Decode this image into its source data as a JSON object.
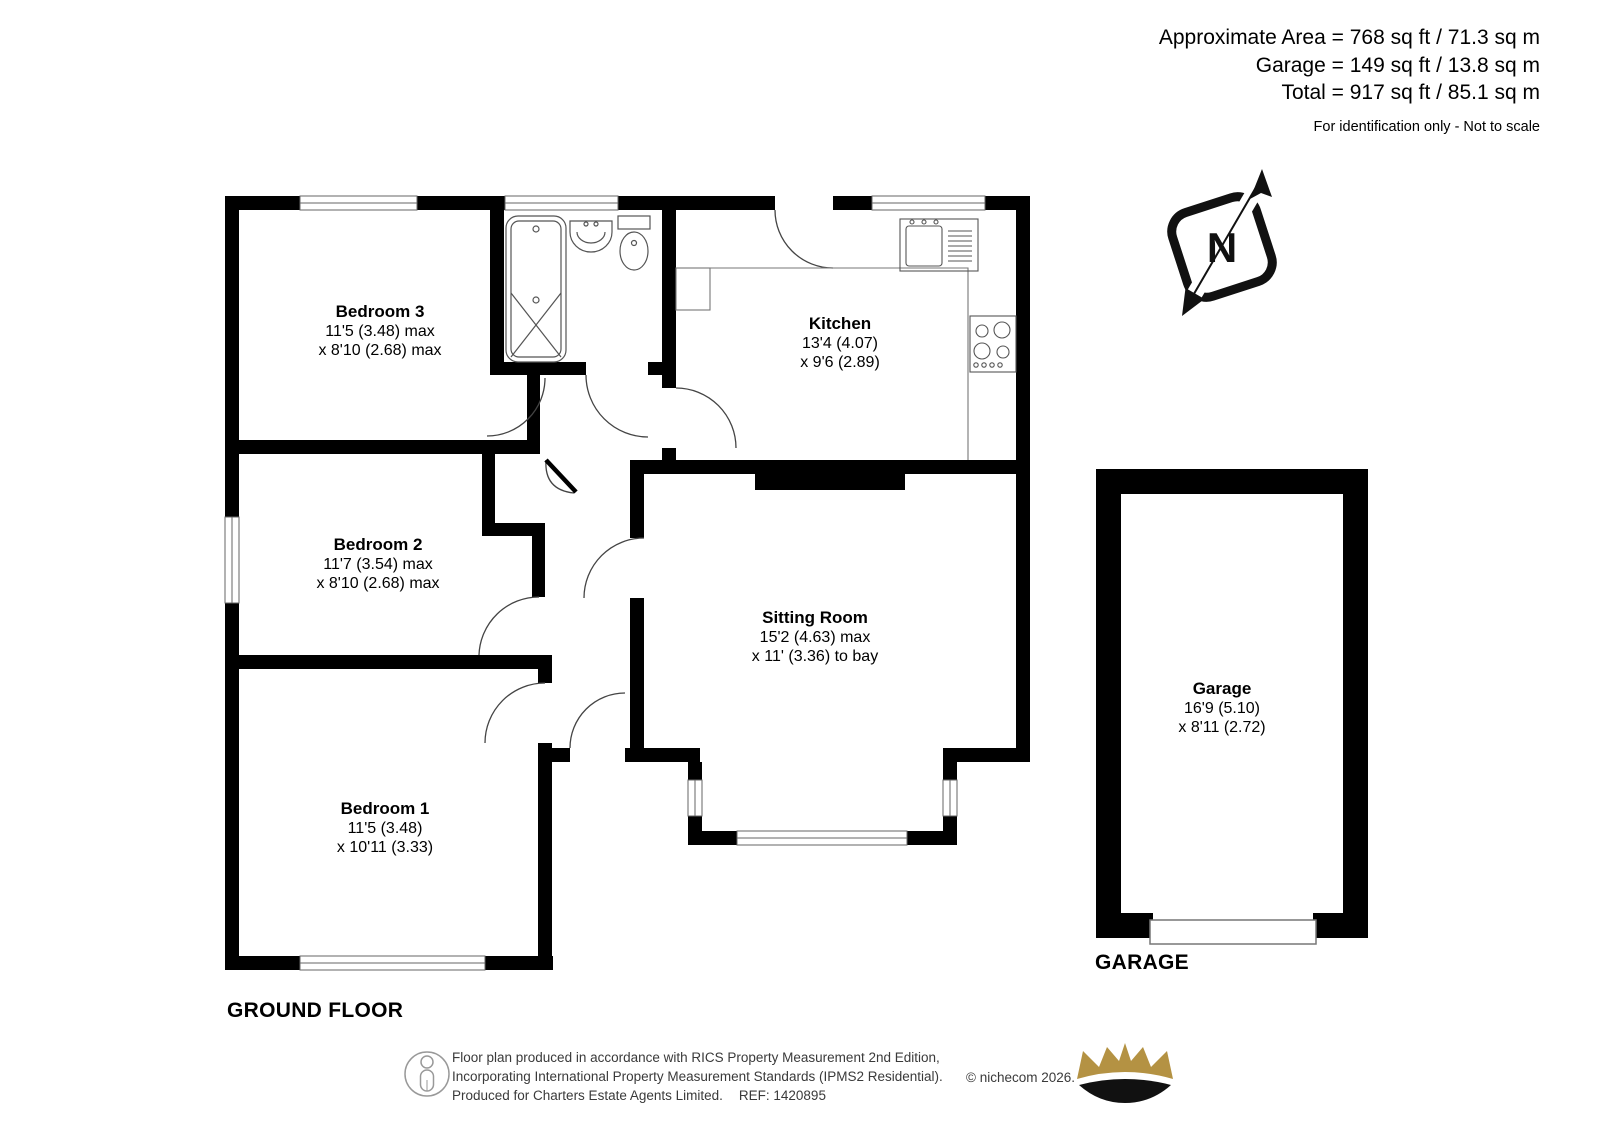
{
  "header": {
    "area_line": "Approximate Area = 768 sq ft / 71.3 sq m",
    "garage_line": "Garage = 149 sq ft / 13.8 sq m",
    "total_line": "Total = 917 sq ft / 85.1 sq m",
    "disclaimer": "For identification only - Not to scale"
  },
  "compass": {
    "label": "N"
  },
  "rooms": [
    {
      "name": "Bedroom 3",
      "line1": "11'5 (3.48) max",
      "line2": "x 8'10 (2.68) max"
    },
    {
      "name": "Kitchen",
      "line1": "13'4 (4.07)",
      "line2": "x 9'6 (2.89)"
    },
    {
      "name": "Bedroom 2",
      "line1": "11'7 (3.54) max",
      "line2": "x 8'10 (2.68) max"
    },
    {
      "name": "Sitting Room",
      "line1": "15'2 (4.63) max",
      "line2": "x 11' (3.36) to bay"
    },
    {
      "name": "Bedroom 1",
      "line1": "11'5 (3.48)",
      "line2": "x 10'11 (3.33)"
    },
    {
      "name": "Garage",
      "line1": "16'9 (5.10)",
      "line2": "x 8'11 (2.72)"
    }
  ],
  "floor_labels": {
    "ground": "GROUND FLOOR",
    "garage": "GARAGE"
  },
  "footer": {
    "line1": "Floor plan produced in accordance with RICS Property Measurement 2nd Edition,",
    "line2": "Incorporating International Property Measurement Standards (IPMS2 Residential).",
    "copyright": "© nichecom 2026.",
    "line3": "Produced for Charters Estate Agents Limited.",
    "ref": "REF: 1420895"
  },
  "colors": {
    "wall": "#000000",
    "fixture": "#555555",
    "crown_gold": "#b49243"
  },
  "icons": [
    "north-compass-icon",
    "rics-person-icon",
    "crown-logo"
  ]
}
